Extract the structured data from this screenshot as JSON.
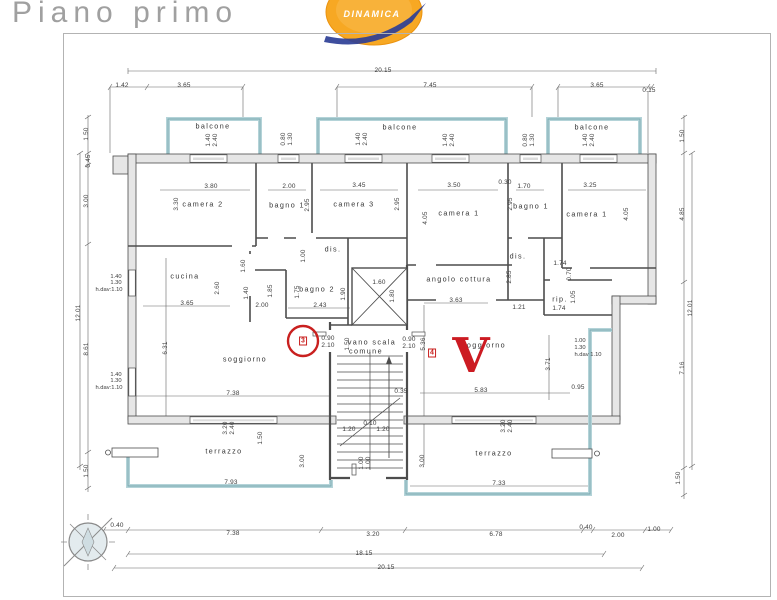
{
  "title": "Piano primo",
  "logo": {
    "name": "DINAMICA"
  },
  "colors": {
    "accent_red": "#c9201f",
    "balcony_teal": "#a8ccd2",
    "wall_gray": "#4d4d4d",
    "logo_orange": "#f7a823",
    "logo_blue": "#2e3f96"
  },
  "plan": {
    "rooms": [
      {
        "t": "balcone",
        "x": 213,
        "y": 126
      },
      {
        "t": "balcone",
        "x": 400,
        "y": 127
      },
      {
        "t": "balcone",
        "x": 592,
        "y": 127
      },
      {
        "t": "camera 2",
        "x": 203,
        "y": 204
      },
      {
        "t": "bagno 1",
        "x": 287,
        "y": 205
      },
      {
        "t": "camera 3",
        "x": 354,
        "y": 204
      },
      {
        "t": "camera 1",
        "x": 459,
        "y": 213
      },
      {
        "t": "bagno 1",
        "x": 531,
        "y": 206
      },
      {
        "t": "camera 1",
        "x": 587,
        "y": 214
      },
      {
        "t": "cucina",
        "x": 185,
        "y": 276
      },
      {
        "t": "dis.",
        "x": 333,
        "y": 249
      },
      {
        "t": "bagno 2",
        "x": 317,
        "y": 289
      },
      {
        "t": "angolo cottura",
        "x": 459,
        "y": 279
      },
      {
        "t": "dis.",
        "x": 518,
        "y": 256
      },
      {
        "t": "rip.",
        "x": 560,
        "y": 299
      },
      {
        "t": "soggiorno",
        "x": 245,
        "y": 359
      },
      {
        "t": "vano scala",
        "x": 372,
        "y": 342
      },
      {
        "t": "comune",
        "x": 366,
        "y": 351
      },
      {
        "t": "soggiorno",
        "x": 484,
        "y": 345
      },
      {
        "t": "terrazzo",
        "x": 224,
        "y": 451
      },
      {
        "t": "terrazzo",
        "x": 494,
        "y": 453
      }
    ],
    "dims": [
      {
        "t": "20.15",
        "x": 383,
        "y": 71
      },
      {
        "t": "1.42",
        "x": 122,
        "y": 86
      },
      {
        "t": "3.65",
        "x": 184,
        "y": 86
      },
      {
        "t": "7.45",
        "x": 430,
        "y": 86
      },
      {
        "t": "3.65",
        "x": 597,
        "y": 86
      },
      {
        "t": "0.15",
        "x": 649,
        "y": 91
      },
      {
        "t": "1.40",
        "x": 209,
        "y": 140,
        "v": 1
      },
      {
        "t": "2.40",
        "x": 216,
        "y": 140,
        "v": 1
      },
      {
        "t": "0.80",
        "x": 284,
        "y": 139,
        "v": 1
      },
      {
        "t": "1.30",
        "x": 291,
        "y": 139,
        "v": 1
      },
      {
        "t": "1.40",
        "x": 359,
        "y": 139,
        "v": 1
      },
      {
        "t": "2.40",
        "x": 366,
        "y": 139,
        "v": 1
      },
      {
        "t": "1.40",
        "x": 446,
        "y": 140,
        "v": 1
      },
      {
        "t": "2.40",
        "x": 453,
        "y": 140,
        "v": 1
      },
      {
        "t": "0.80",
        "x": 526,
        "y": 140,
        "v": 1
      },
      {
        "t": "1.30",
        "x": 533,
        "y": 140,
        "v": 1
      },
      {
        "t": "1.40",
        "x": 586,
        "y": 140,
        "v": 1
      },
      {
        "t": "2.40",
        "x": 593,
        "y": 140,
        "v": 1
      },
      {
        "t": "3.80",
        "x": 211,
        "y": 187
      },
      {
        "t": "3.30",
        "x": 177,
        "y": 204,
        "v": 1
      },
      {
        "t": "2.00",
        "x": 289,
        "y": 187
      },
      {
        "t": "2.95",
        "x": 308,
        "y": 205,
        "v": 1
      },
      {
        "t": "3.45",
        "x": 359,
        "y": 186
      },
      {
        "t": "2.95",
        "x": 398,
        "y": 204,
        "v": 1
      },
      {
        "t": "3.50",
        "x": 454,
        "y": 186
      },
      {
        "t": "4.05",
        "x": 426,
        "y": 218,
        "v": 1
      },
      {
        "t": "0.30",
        "x": 505,
        "y": 183
      },
      {
        "t": "1.70",
        "x": 524,
        "y": 187
      },
      {
        "t": "2.95",
        "x": 511,
        "y": 204,
        "v": 1
      },
      {
        "t": "3.25",
        "x": 590,
        "y": 186
      },
      {
        "t": "4.05",
        "x": 627,
        "y": 214,
        "v": 1
      },
      {
        "t": "1.00",
        "x": 304,
        "y": 256,
        "v": 1
      },
      {
        "t": "1.60",
        "x": 244,
        "y": 266,
        "v": 1
      },
      {
        "t": "1.40",
        "x": 247,
        "y": 293,
        "v": 1
      },
      {
        "t": "2.60",
        "x": 218,
        "y": 288,
        "v": 1
      },
      {
        "t": "1.85",
        "x": 271,
        "y": 291,
        "v": 1
      },
      {
        "t": "1.75",
        "x": 298,
        "y": 292,
        "v": 1
      },
      {
        "t": "1.90",
        "x": 344,
        "y": 294,
        "v": 1
      },
      {
        "t": "1.80",
        "x": 393,
        "y": 296,
        "v": 1
      },
      {
        "t": "1.60",
        "x": 379,
        "y": 283
      },
      {
        "t": "3.65",
        "x": 187,
        "y": 304
      },
      {
        "t": "2.00",
        "x": 262,
        "y": 306
      },
      {
        "t": "2.43",
        "x": 320,
        "y": 306
      },
      {
        "t": "3.63",
        "x": 456,
        "y": 301
      },
      {
        "t": "2.85",
        "x": 510,
        "y": 277,
        "v": 1
      },
      {
        "t": "1.21",
        "x": 519,
        "y": 308
      },
      {
        "t": "1.74",
        "x": 560,
        "y": 264
      },
      {
        "t": "0.70",
        "x": 570,
        "y": 274,
        "v": 1
      },
      {
        "t": "1.05",
        "x": 574,
        "y": 297,
        "v": 1
      },
      {
        "t": "1.74",
        "x": 559,
        "y": 309
      },
      {
        "t": "6.31",
        "x": 166,
        "y": 348,
        "v": 1
      },
      {
        "t": "0.90",
        "x": 328,
        "y": 339
      },
      {
        "t": "2.10",
        "x": 328,
        "y": 346
      },
      {
        "t": "0.90",
        "x": 409,
        "y": 340
      },
      {
        "t": "2.10",
        "x": 409,
        "y": 347
      },
      {
        "t": "1.50",
        "x": 348,
        "y": 344,
        "v": 1
      },
      {
        "t": "5.36",
        "x": 424,
        "y": 344,
        "v": 1
      },
      {
        "t": "7.38",
        "x": 233,
        "y": 394
      },
      {
        "t": "0.35",
        "x": 401,
        "y": 392
      },
      {
        "t": "5.83",
        "x": 481,
        "y": 391
      },
      {
        "t": "3.71",
        "x": 549,
        "y": 364,
        "v": 1
      },
      {
        "t": "0.95",
        "x": 578,
        "y": 388
      },
      {
        "t": "1.20",
        "x": 349,
        "y": 430
      },
      {
        "t": "0.10",
        "x": 370,
        "y": 424
      },
      {
        "t": "1.20",
        "x": 383,
        "y": 430
      },
      {
        "t": "1.00",
        "x": 362,
        "y": 463,
        "v": 1
      },
      {
        "t": "1.00",
        "x": 369,
        "y": 463,
        "v": 1
      },
      {
        "t": "3.20",
        "x": 226,
        "y": 428,
        "v": 1
      },
      {
        "t": "2.40",
        "x": 233,
        "y": 428,
        "v": 1
      },
      {
        "t": "1.50",
        "x": 261,
        "y": 438,
        "v": 1
      },
      {
        "t": "3.00",
        "x": 303,
        "y": 461,
        "v": 1
      },
      {
        "t": "3.00",
        "x": 423,
        "y": 461,
        "v": 1
      },
      {
        "t": "3.20",
        "x": 504,
        "y": 426,
        "v": 1
      },
      {
        "t": "2.40",
        "x": 511,
        "y": 426,
        "v": 1
      },
      {
        "t": "7.93",
        "x": 231,
        "y": 483
      },
      {
        "t": "7.33",
        "x": 499,
        "y": 484
      },
      {
        "t": "1.50",
        "x": 87,
        "y": 134,
        "v": 1
      },
      {
        "t": "0.45",
        "x": 89,
        "y": 161,
        "v": 1
      },
      {
        "t": "3.00",
        "x": 87,
        "y": 201,
        "v": 1
      },
      {
        "t": "12.01",
        "x": 79,
        "y": 313,
        "v": 1
      },
      {
        "t": "8.61",
        "x": 87,
        "y": 349,
        "v": 1
      },
      {
        "t": "1.50",
        "x": 87,
        "y": 471,
        "v": 1
      },
      {
        "t": "1.50",
        "x": 683,
        "y": 136,
        "v": 1
      },
      {
        "t": "4.85",
        "x": 683,
        "y": 214,
        "v": 1
      },
      {
        "t": "12.01",
        "x": 691,
        "y": 308,
        "v": 1
      },
      {
        "t": "7.16",
        "x": 683,
        "y": 368,
        "v": 1
      },
      {
        "t": "1.50",
        "x": 679,
        "y": 478,
        "v": 1
      },
      {
        "t": "0.40",
        "x": 117,
        "y": 526
      },
      {
        "t": "7.38",
        "x": 233,
        "y": 534
      },
      {
        "t": "3.20",
        "x": 373,
        "y": 535
      },
      {
        "t": "6.78",
        "x": 496,
        "y": 535
      },
      {
        "t": "0.40",
        "x": 586,
        "y": 528
      },
      {
        "t": "2.00",
        "x": 618,
        "y": 536
      },
      {
        "t": "1.00",
        "x": 654,
        "y": 530
      },
      {
        "t": "18.15",
        "x": 364,
        "y": 554
      },
      {
        "t": "20.15",
        "x": 386,
        "y": 568
      }
    ],
    "sills": [
      {
        "t": "1.40",
        "x": 116,
        "y": 278
      },
      {
        "t": "1.30",
        "x": 116,
        "y": 284
      },
      {
        "t": "h.dav:1.10",
        "x": 109,
        "y": 291
      },
      {
        "t": "1.40",
        "x": 116,
        "y": 376
      },
      {
        "t": "1.30",
        "x": 116,
        "y": 382
      },
      {
        "t": "h.dav:1.10",
        "x": 109,
        "y": 389
      },
      {
        "t": "1.00",
        "x": 580,
        "y": 342
      },
      {
        "t": "1.30",
        "x": 580,
        "y": 349
      },
      {
        "t": "h.dav 1.10",
        "x": 588,
        "y": 356
      }
    ],
    "markers": [
      {
        "t": "3",
        "x": 303,
        "y": 341,
        "c": "marker-box"
      },
      {
        "t": "4",
        "x": 432,
        "y": 353,
        "c": "marker-box"
      },
      {
        "t": "V",
        "x": 471,
        "y": 356,
        "c": "marker-big"
      }
    ]
  }
}
